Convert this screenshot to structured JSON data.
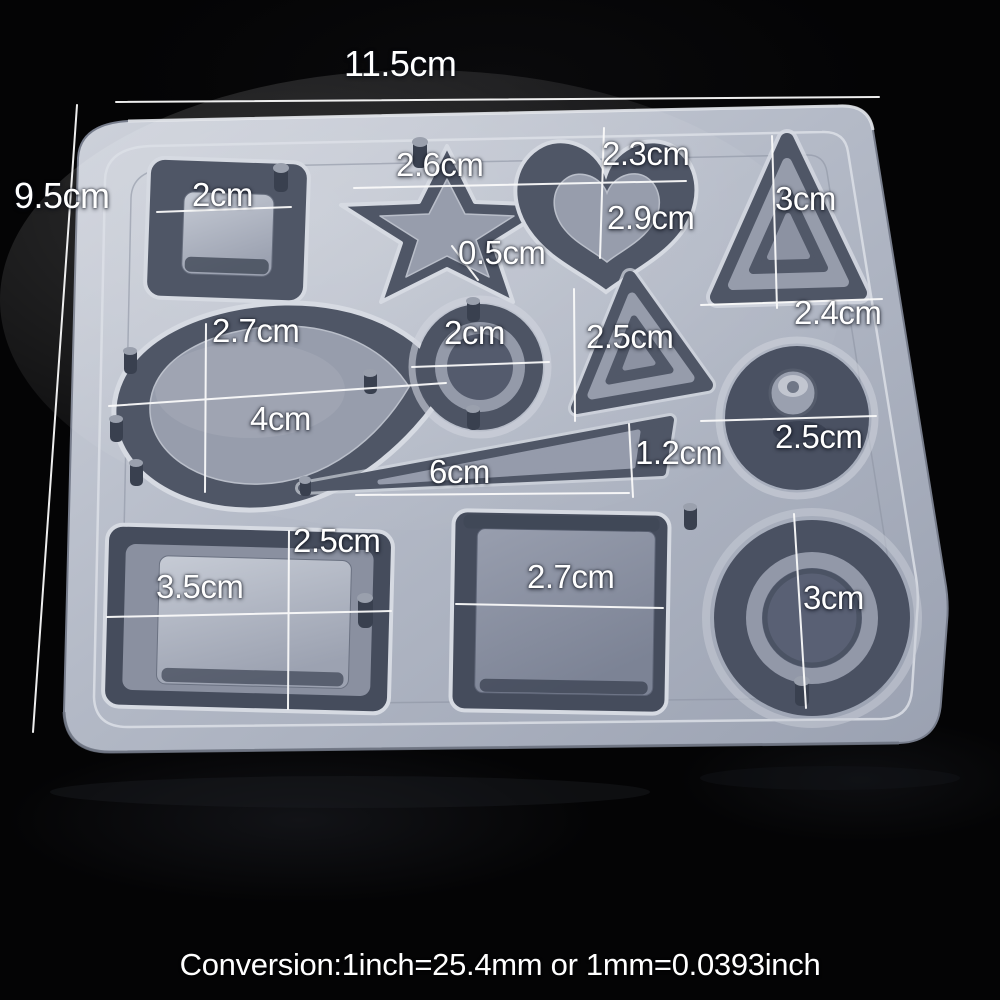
{
  "photo": {
    "subject": "silicone-resin-jewelry-mold",
    "width_label": "11.5cm",
    "height_label": "9.5cm",
    "caption": "Conversion:1inch=25.4mm or 1mm=0.0393inch"
  },
  "cavity_shapes": [
    "square",
    "star",
    "heart",
    "triangle",
    "teardrop",
    "circle",
    "triangle",
    "circle",
    "spike",
    "rectangle",
    "square",
    "circle"
  ],
  "dimensions": {
    "square_top": "2cm",
    "star_width": "2.6cm",
    "star_edge": "0.5cm",
    "heart_width": "2.3cm",
    "heart_height": "2.9cm",
    "triangle_right_height": "3cm",
    "triangle_right_base": "2.4cm",
    "teardrop_width": "2.7cm",
    "teardrop_length": "4cm",
    "circle_middle": "2cm",
    "triangle_middle": "2.5cm",
    "circle_right": "2.5cm",
    "spike_length": "6cm",
    "spike_height": "1.2cm",
    "rect_width": "3.5cm",
    "rect_height": "2.5cm",
    "square_bottom": "2.7cm",
    "circle_bottom": "3cm"
  },
  "colors": {
    "background": "#040405",
    "mold_surface": "#b7bcc8",
    "cavity_dark": "#4f5666",
    "raised_mid": "#979dac",
    "highlight": "#e8eaef",
    "annotation": "#ffffff"
  }
}
